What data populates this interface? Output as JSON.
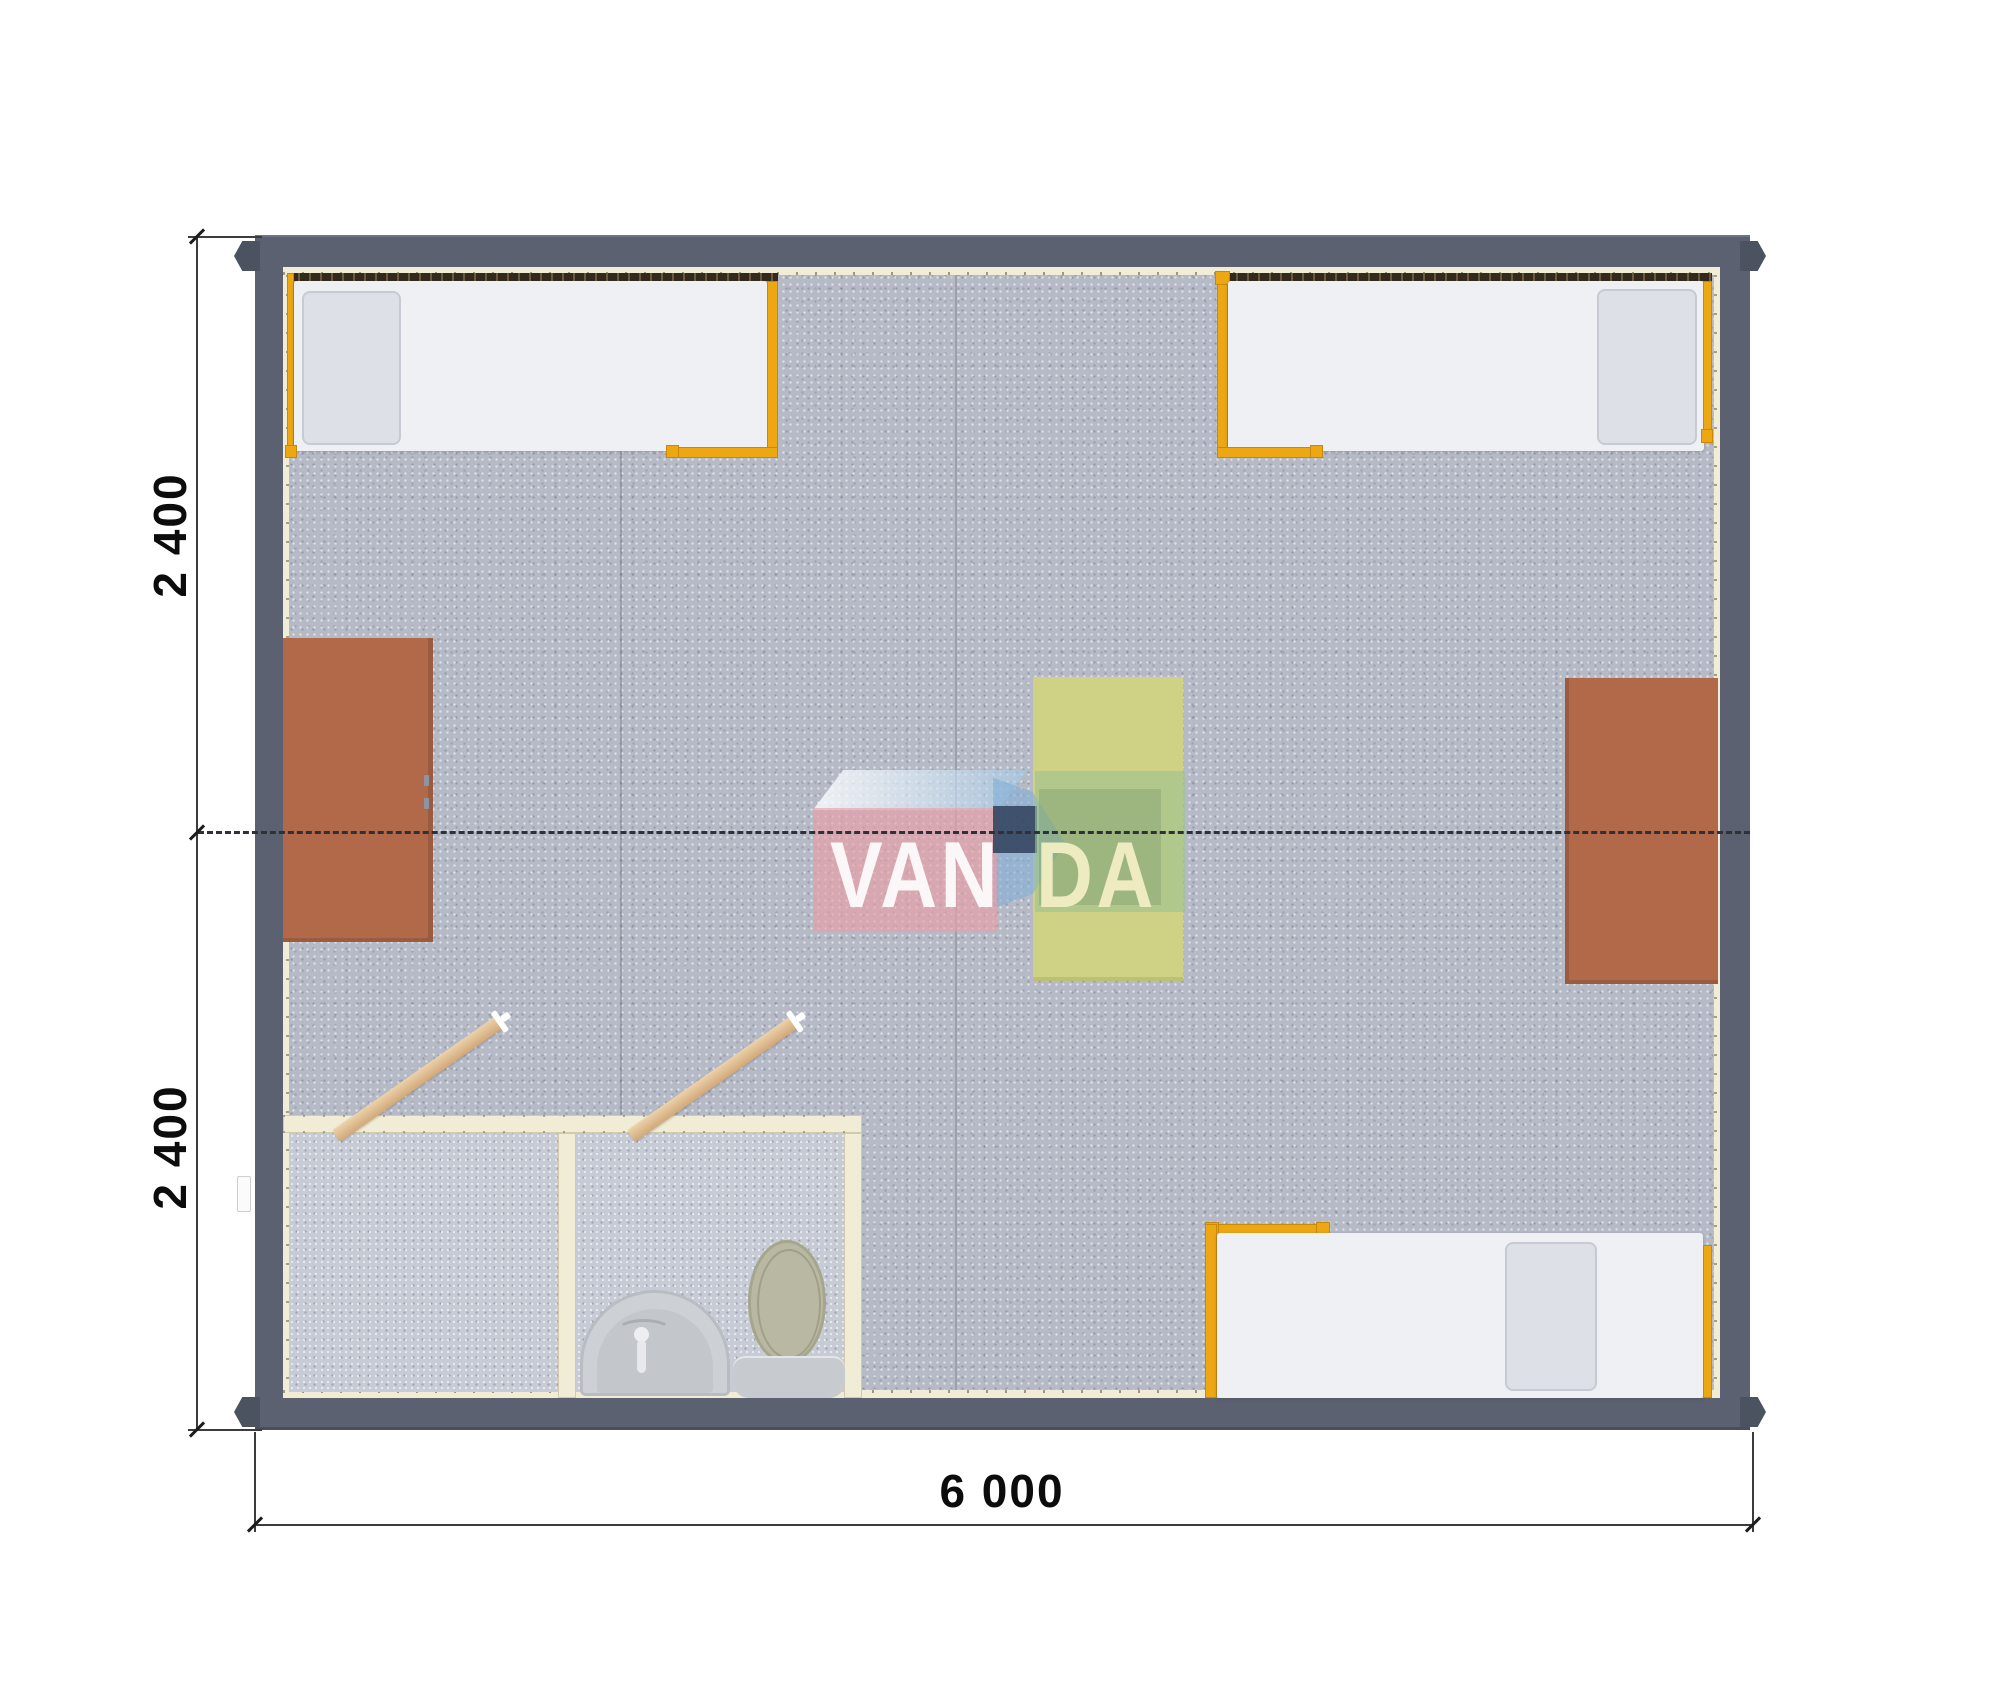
{
  "document": {
    "type": "floor-plan-render",
    "subject": "modular cabin top view with three beds, two cabinets, table and bathroom"
  },
  "dimensions": {
    "left_top": "2 400",
    "left_bottom": "2 400",
    "bottom": "6 000"
  },
  "watermark": {
    "part1": "VAN",
    "part2": "DA"
  },
  "items": [
    "bed-icon",
    "bed-icon",
    "bed-icon",
    "cabinet-icon",
    "cabinet-icon",
    "table-icon",
    "sink-icon",
    "toilet-icon",
    "door-icon",
    "door-icon"
  ],
  "colors": {
    "wall": "#5b6170",
    "corner_casting": "#4b5260",
    "wall_liner": "#f1ecd6",
    "floor_carpet": "#b6bac6",
    "bathroom_floor": "#c7cbd5",
    "bed_frame_orange": "#eca712",
    "mattress": "#eef0f3",
    "pillow": "#dde1e7",
    "cabinet_brown": "#b1694a",
    "table_yellow": "#cfd185",
    "door_wood": "#ddb88d",
    "logo_pink": "#e89fa7",
    "logo_blue": "#9fc8e6",
    "logo_navy": "#2f405a",
    "logo_green": "#9cc192",
    "dashed_line": "#2e3238",
    "dimension_text": "#0c0c0c"
  }
}
